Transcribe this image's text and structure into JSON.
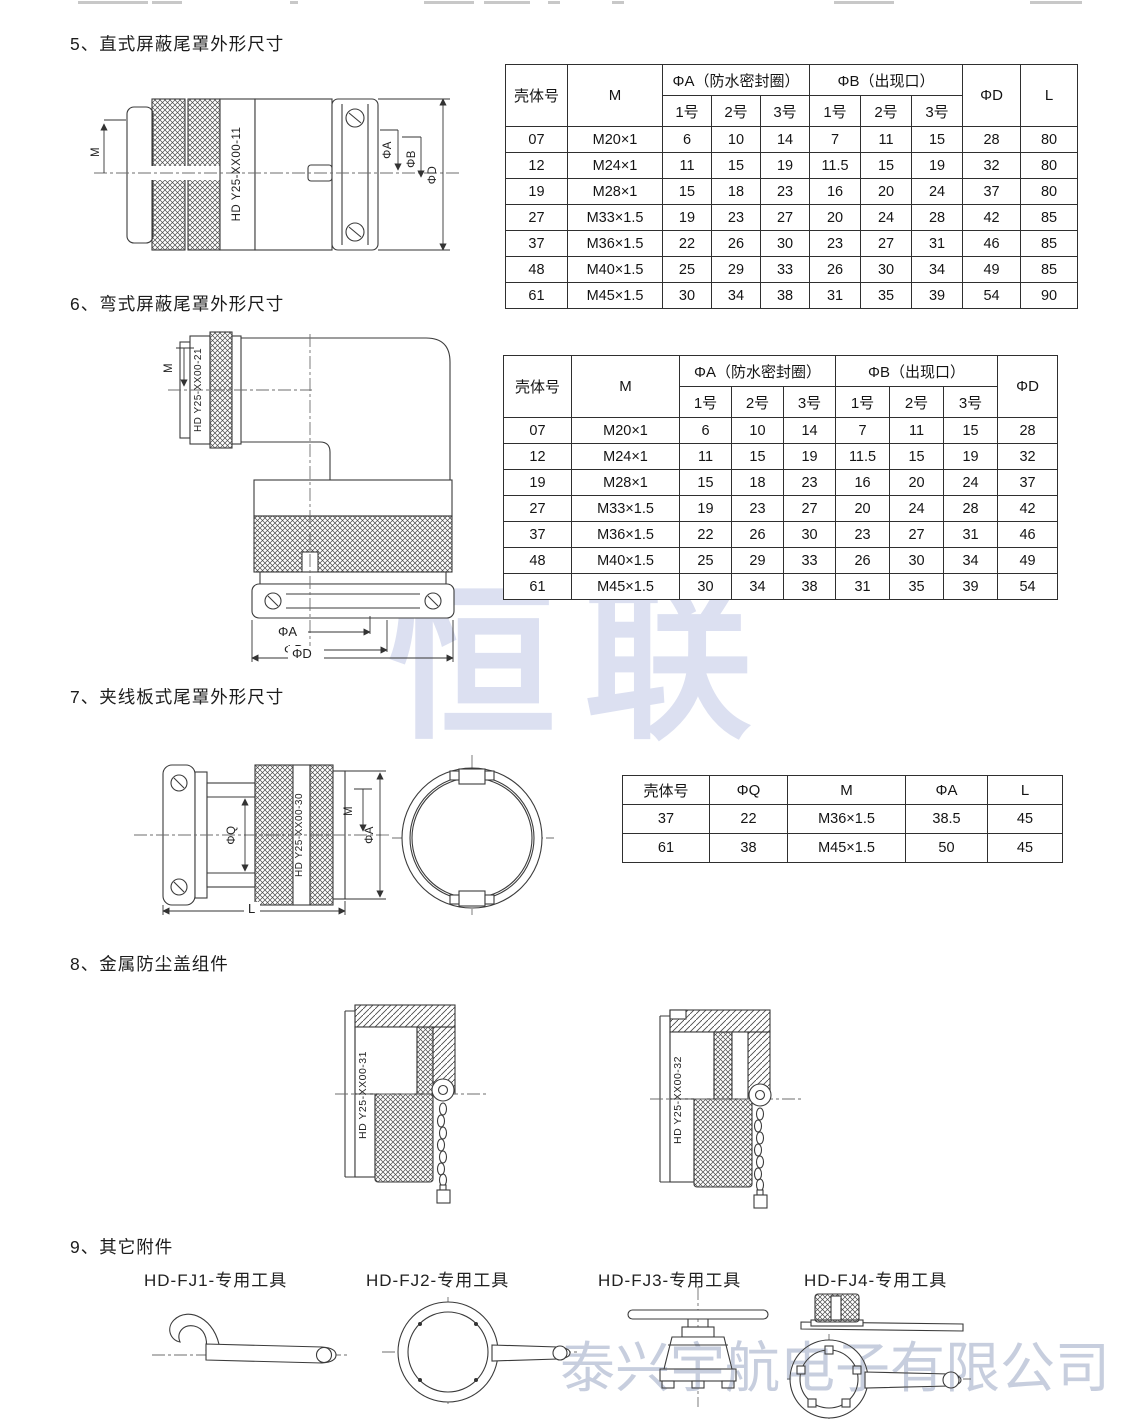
{
  "watermarks": {
    "center": "恒联",
    "bottom": "泰兴宇航电子有限公司"
  },
  "section5": {
    "title": "5、直式屏蔽尾罩外形尺寸",
    "drawing": {
      "label": "HD Y25-XX00-11",
      "dim_m": "M",
      "dim_a": "ΦA",
      "dim_b": "ΦB",
      "dim_d": "ΦD"
    },
    "table": {
      "col_shell": "壳体号",
      "col_m": "M",
      "col_a_group": "ΦA（防水密封圈）",
      "col_b_group": "ΦB（出现口）",
      "sub_cols": [
        "1号",
        "2号",
        "3号"
      ],
      "col_d": "ΦD",
      "col_l": "L",
      "rows": [
        [
          "07",
          "M20×1",
          "6",
          "10",
          "14",
          "7",
          "11",
          "15",
          "28",
          "80"
        ],
        [
          "12",
          "M24×1",
          "11",
          "15",
          "19",
          "11.5",
          "15",
          "19",
          "32",
          "80"
        ],
        [
          "19",
          "M28×1",
          "15",
          "18",
          "23",
          "16",
          "20",
          "24",
          "37",
          "80"
        ],
        [
          "27",
          "M33×1.5",
          "19",
          "23",
          "27",
          "20",
          "24",
          "28",
          "42",
          "85"
        ],
        [
          "37",
          "M36×1.5",
          "22",
          "26",
          "30",
          "23",
          "27",
          "31",
          "46",
          "85"
        ],
        [
          "48",
          "M40×1.5",
          "25",
          "29",
          "33",
          "26",
          "30",
          "34",
          "49",
          "85"
        ],
        [
          "61",
          "M45×1.5",
          "30",
          "34",
          "38",
          "31",
          "35",
          "39",
          "54",
          "90"
        ]
      ]
    }
  },
  "section6": {
    "title": "6、弯式屏蔽尾罩外形尺寸",
    "drawing": {
      "label": "HD Y25-XX00-21",
      "dim_m": "M",
      "dim_a": "ΦA",
      "dim_b": "ΦB",
      "dim_d": "ΦD"
    },
    "table": {
      "col_shell": "壳体号",
      "col_m": "M",
      "col_a_group": "ΦA（防水密封圈）",
      "col_b_group": "ΦB（出现口）",
      "sub_cols": [
        "1号",
        "2号",
        "3号"
      ],
      "col_d": "ΦD",
      "rows": [
        [
          "07",
          "M20×1",
          "6",
          "10",
          "14",
          "7",
          "11",
          "15",
          "28"
        ],
        [
          "12",
          "M24×1",
          "11",
          "15",
          "19",
          "11.5",
          "15",
          "19",
          "32"
        ],
        [
          "19",
          "M28×1",
          "15",
          "18",
          "23",
          "16",
          "20",
          "24",
          "37"
        ],
        [
          "27",
          "M33×1.5",
          "19",
          "23",
          "27",
          "20",
          "24",
          "28",
          "42"
        ],
        [
          "37",
          "M36×1.5",
          "22",
          "26",
          "30",
          "23",
          "27",
          "31",
          "46"
        ],
        [
          "48",
          "M40×1.5",
          "25",
          "29",
          "33",
          "26",
          "30",
          "34",
          "49"
        ],
        [
          "61",
          "M45×1.5",
          "30",
          "34",
          "38",
          "31",
          "35",
          "39",
          "54"
        ]
      ]
    }
  },
  "section7": {
    "title": "7、夹线板式尾罩外形尺寸",
    "drawing": {
      "label": "HD Y25-XX00-30",
      "dim_q": "ΦQ",
      "dim_m": "M",
      "dim_a": "ΦA",
      "dim_l": "L"
    },
    "table": {
      "headers": [
        "壳体号",
        "ΦQ",
        "M",
        "ΦA",
        "L"
      ],
      "rows": [
        [
          "37",
          "22",
          "M36×1.5",
          "38.5",
          "45"
        ],
        [
          "61",
          "38",
          "M45×1.5",
          "50",
          "45"
        ]
      ]
    }
  },
  "section8": {
    "title": "8、金属防尘盖组件",
    "cap_left_label": "HD Y25-XX00-31",
    "cap_right_label": "HD Y25-XX00-32"
  },
  "section9": {
    "title": "9、其它附件",
    "tools": [
      {
        "label": "HD-FJ1-专用工具"
      },
      {
        "label": "HD-FJ2-专用工具"
      },
      {
        "label": "HD-FJ3-专用工具"
      },
      {
        "label": "HD-FJ4-专用工具"
      }
    ]
  }
}
